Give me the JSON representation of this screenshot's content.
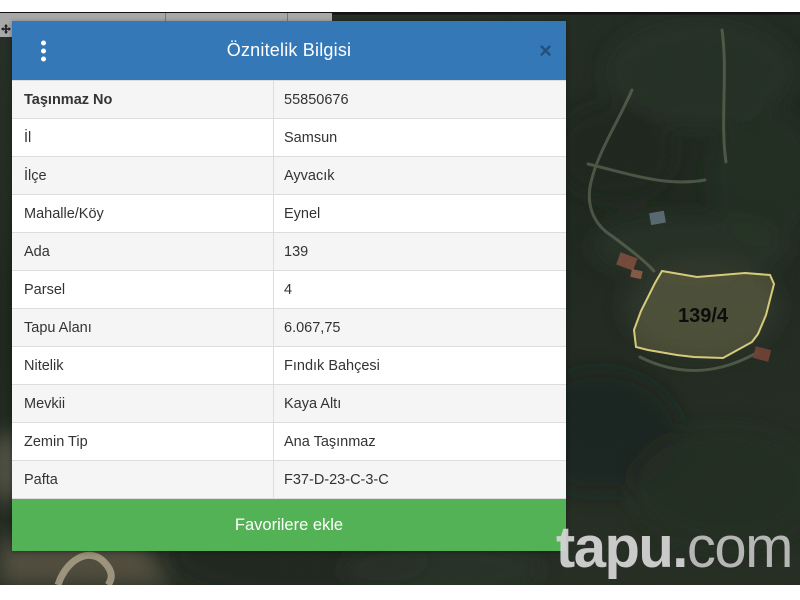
{
  "map": {
    "parcel_label": "139/4",
    "parcel_stroke_color": "#d6ca7c",
    "watermark": {
      "bold": "tapu.",
      "light": "com"
    }
  },
  "panel": {
    "title": "Öznitelik Bilgisi",
    "close_icon": "×",
    "header_color": "#3478b8",
    "rows": [
      {
        "label": "Taşınmaz No",
        "value": "55850676"
      },
      {
        "label": "İl",
        "value": "Samsun"
      },
      {
        "label": "İlçe",
        "value": "Ayvacık"
      },
      {
        "label": "Mahalle/Köy",
        "value": "Eynel"
      },
      {
        "label": "Ada",
        "value": "139"
      },
      {
        "label": "Parsel",
        "value": "4"
      },
      {
        "label": "Tapu Alanı",
        "value": "6.067,75"
      },
      {
        "label": "Nitelik",
        "value": "Fındık Bahçesi"
      },
      {
        "label": "Mevkii",
        "value": "Kaya Altı"
      },
      {
        "label": "Zemin Tip",
        "value": "Ana Taşınmaz"
      },
      {
        "label": "Pafta",
        "value": "F37-D-23-C-3-C"
      }
    ],
    "favorite_button_label": "Favorilere ekle",
    "favorite_button_color": "#53b156"
  }
}
